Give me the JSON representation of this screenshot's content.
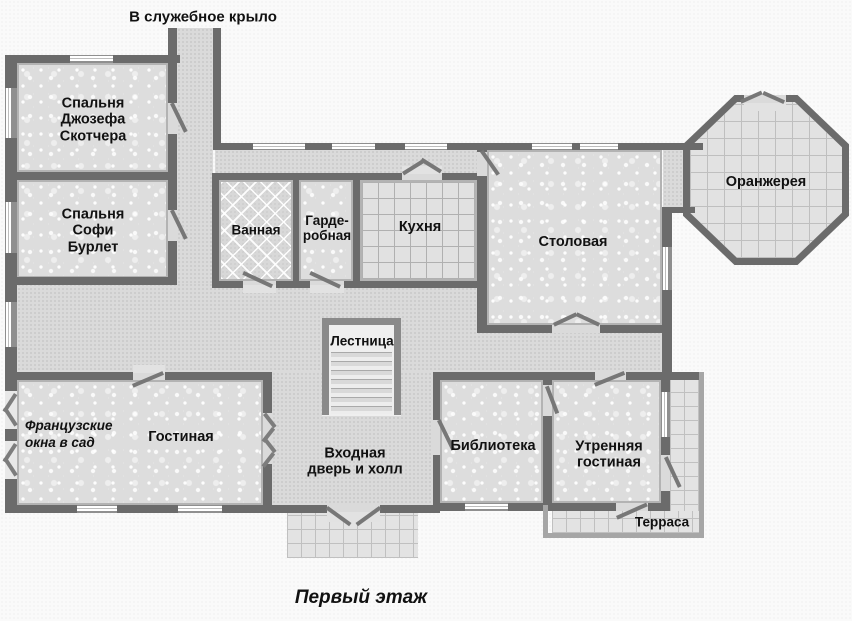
{
  "plan": {
    "service_wing_label": "В служебное крыло",
    "caption": "Первый этаж",
    "rooms": {
      "bedroom_scotcher": "Спальня\nДжозефа\nСкотчера",
      "bedroom_burlet": "Спальня\nСофи\nБурлет",
      "bathroom": "Ванная",
      "wardrobe": "Гарде-\nробная",
      "kitchen": "Кухня",
      "dining": "Столовая",
      "orangery": "Оранжерея",
      "stairs": "Лестница",
      "living": "Гостиная",
      "french_windows_note": "Французские\nокна в сад",
      "entrance": "Входная\nдверь и холл",
      "library": "Библиотека",
      "morning_room": "Утренняя\nгостиная",
      "terrace": "Терраса"
    },
    "colors": {
      "wall": "#6b6b6b",
      "wall_trim": "#b3b3b3",
      "room_fill": "#dddddd",
      "hall_fill": "#dadada",
      "background": "#fafafa",
      "text": "#111111"
    }
  }
}
